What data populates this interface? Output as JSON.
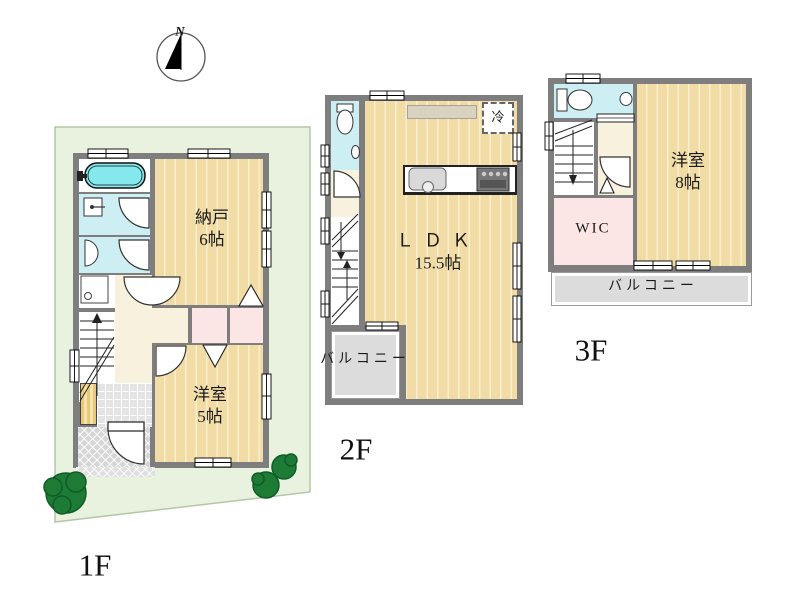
{
  "colors": {
    "wall": "#7e7e7e",
    "wood": "#f2dca6",
    "woodline": "#faeecd",
    "lot": "#e9f2df",
    "lotline": "#b4c6a6",
    "water": "#cdeff3",
    "tub": "#84e8ec",
    "pink": "#fbe5e5",
    "hall": "#f8f1de",
    "balcony": "#dcdcdc",
    "tile": "#e4e4e4",
    "porch": "#d6d6d6",
    "tree": "#1d7b35",
    "cupboard": "#d8d2c0"
  },
  "compass": {
    "north_label": "N"
  },
  "floor1": {
    "label": "1F",
    "storage_room": {
      "name": "納戸",
      "size": "6帖"
    },
    "western_room": {
      "name": "洋室",
      "size": "5帖"
    }
  },
  "floor2": {
    "label": "2F",
    "ldk": {
      "name": "ＬＤＫ",
      "size": "15.5帖"
    },
    "balcony_label": "バルコニー",
    "refrigerator_label": "冷"
  },
  "floor3": {
    "label": "3F",
    "western_room": {
      "name": "洋室",
      "size": "8帖"
    },
    "wic_label": "WIC",
    "balcony_label": "バルコニー"
  }
}
